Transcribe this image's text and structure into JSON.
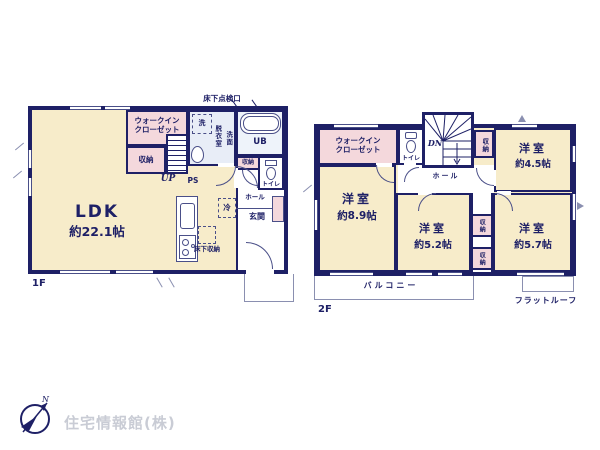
{
  "colors": {
    "wall_navy": "#1e2066",
    "room_cream": "#f7ecca",
    "closet_pink": "#f4d8dc",
    "bath_blue": "#e8edf7",
    "logo_gray": "#c9ccd5"
  },
  "floor1": {
    "label": "1F",
    "inspection_hatch": "床下点検口",
    "ldk_name": "LDK",
    "ldk_size": "約22.1帖",
    "wic": "ウォークイン\nクローゼット",
    "storage1": "収納",
    "washer": "洗",
    "dressing": "脱衣室",
    "vanity": "洗面",
    "unit_bath": "UB",
    "storage2": "収納",
    "toilet": "トイレ",
    "up": "UP",
    "ps": "PS",
    "hall": "ホール",
    "entrance": "玄関",
    "fridge": "冷",
    "underfloor_storage": "床下収納"
  },
  "floor2": {
    "label": "2F",
    "wic": "ウォークイン\nクローゼット",
    "toilet": "トイレ",
    "dn": "DN",
    "storage_stair": "収納",
    "room_a_name": "洋室",
    "room_a_size": "約4.5帖",
    "hall": "ホール",
    "room_b_name": "洋室",
    "room_b_size": "約8.9帖",
    "room_c_name": "洋室",
    "room_c_size": "約5.2帖",
    "storage_a": "収納",
    "storage_b": "収納",
    "room_d_name": "洋室",
    "room_d_size": "約5.7帖",
    "balcony": "バルコニー",
    "flat_roof": "フラットルーフ"
  },
  "footer": {
    "company": "住宅情報館(株)",
    "compass_n": "N"
  }
}
